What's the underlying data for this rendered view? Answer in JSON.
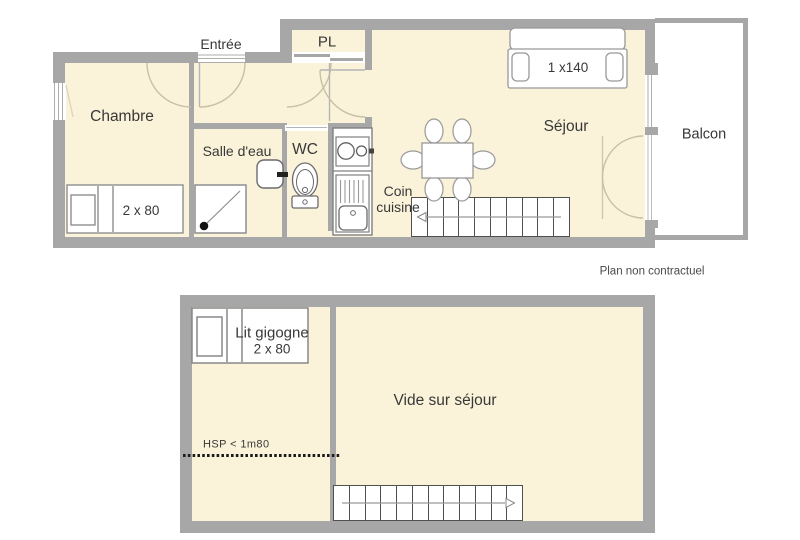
{
  "note": "Plan non contractuel",
  "colors": {
    "wall": "#a7a7a7",
    "floor": "#faf3da",
    "text": "#383838",
    "door_arc": "#c8bfa5",
    "fixture_stroke": "#8e8e8e",
    "stairs_stroke": "#4f4f4f"
  },
  "level1": {
    "labels": {
      "entree": "Entrée",
      "pl": "PL",
      "chambre": "Chambre",
      "salle_deau": "Salle d'eau",
      "wc": "WC",
      "coin_line1": "Coin",
      "coin_line2": "cuisine",
      "sejour": "Séjour",
      "balcon": "Balcon",
      "bed_dim": "2 x 80",
      "sofa_dim": "1 x140"
    }
  },
  "level2": {
    "labels": {
      "lit_line1": "Lit gigogne",
      "lit_line2": "2 x 80",
      "vide": "Vide sur séjour",
      "hsp": "HSP < 1m80"
    }
  }
}
